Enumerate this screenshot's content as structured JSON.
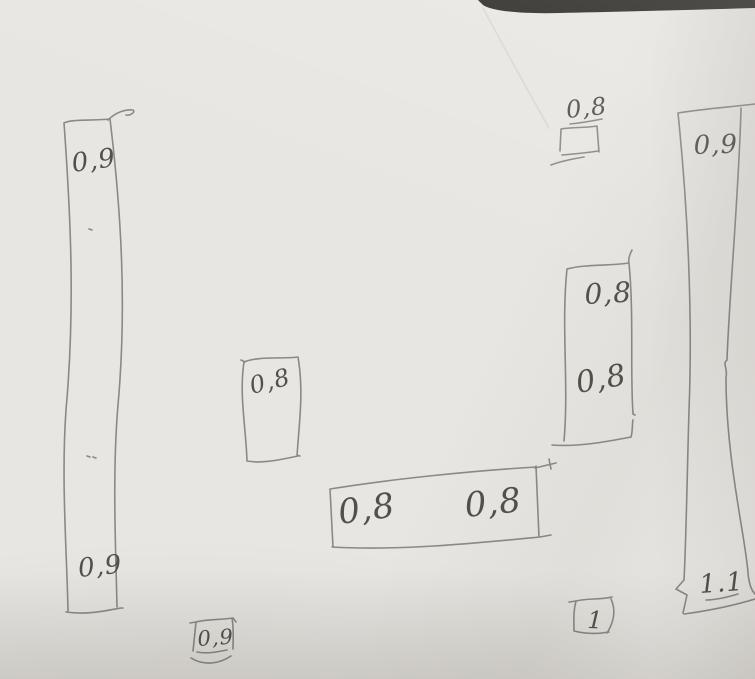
{
  "photo": {
    "paper_color": "#e8e6e2",
    "table_background_color": "#2b2824",
    "pencil_color": "#8b8987",
    "pencil_text_color": "#525049",
    "crease_color": "#cfccc6"
  },
  "labels": {
    "left_bar_top": "0,9",
    "left_bar_bottom": "0,9",
    "small_box": "0,8",
    "wide_box_left": "0,8",
    "wide_box_right": "0,8",
    "top_square": "0,8",
    "right_box_top": "0,8",
    "right_box_bottom": "0,8",
    "far_right_bar_top": "0,9",
    "far_right_bar_bottom": "1.1",
    "bottom_left_note": "0,9",
    "bottom_right_note": "1"
  }
}
